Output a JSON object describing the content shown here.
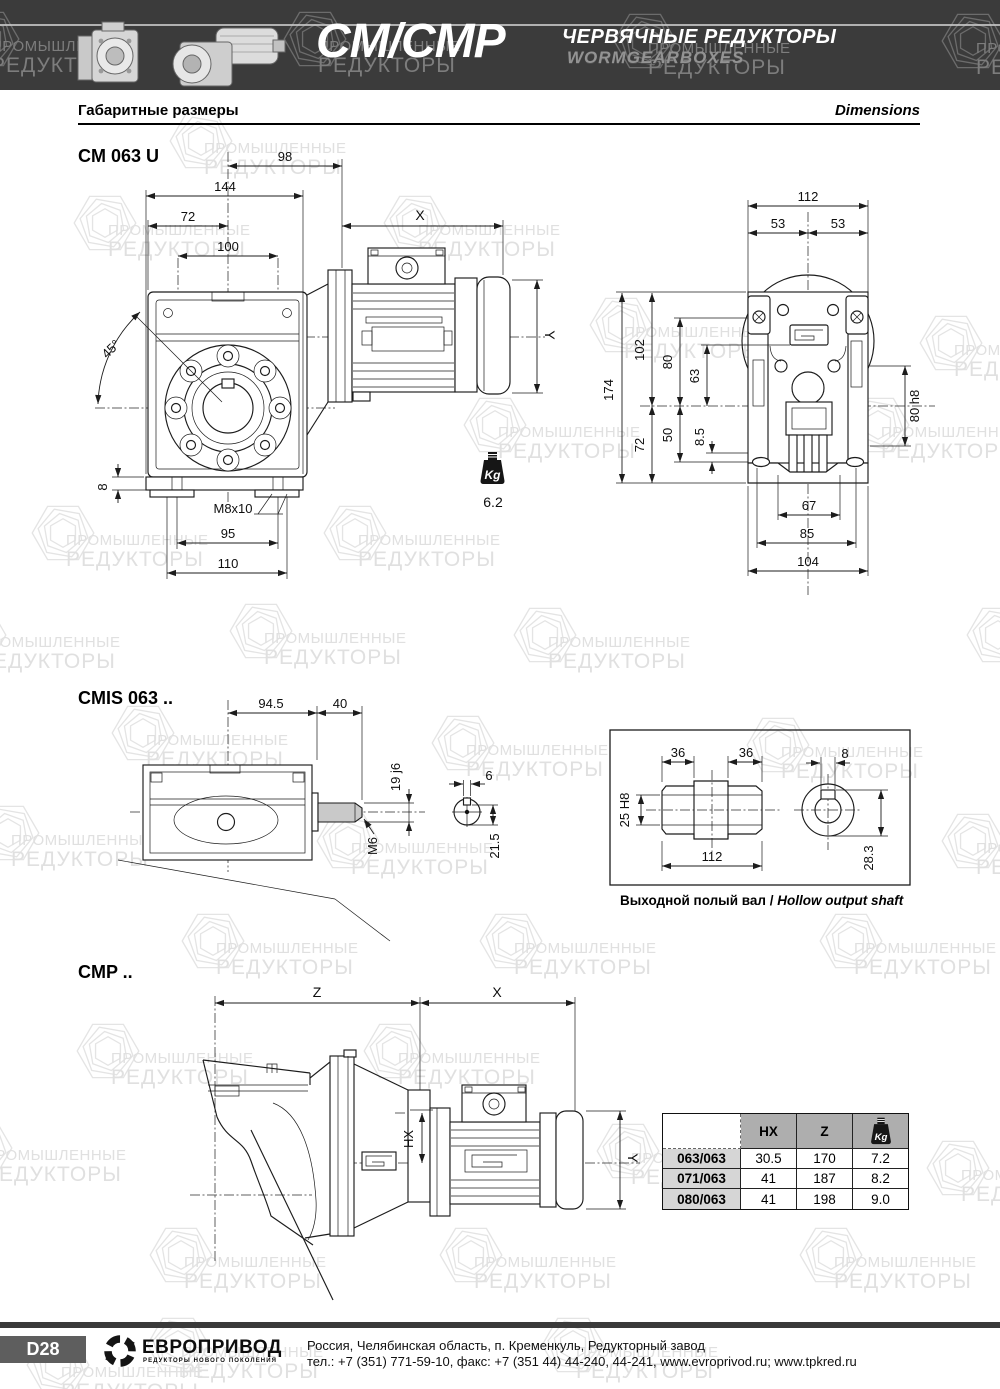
{
  "watermark": {
    "line1": "ПРОМЫШЛЕННЫЕ",
    "line2": "РЕДУКТОРЫ"
  },
  "header": {
    "model": "CM/CMP",
    "title_ru": "ЧЕРВЯЧНЫЕ РЕДУКТОРЫ",
    "title_en": "WORMGEARBOXES"
  },
  "subheader": {
    "left": "Габаритные размеры",
    "right": "Dimensions"
  },
  "weight_icon_label": "Kg",
  "cm063u": {
    "title": "CM 063 U",
    "front": {
      "d98": "98",
      "d144": "144",
      "d72": "72",
      "d100": "100",
      "dX": "X",
      "dY": "Y",
      "angle": "45°",
      "d8": "8",
      "thread": "M8x10",
      "d95": "95",
      "d110": "110",
      "weight": "6.2"
    },
    "side": {
      "d112": "112",
      "d53l": "53",
      "d53r": "53",
      "d174": "174",
      "d102": "102",
      "d80": "80",
      "d63": "63",
      "d72": "72",
      "d50": "50",
      "d8_5": "8.5",
      "d80h8": "80 h8",
      "d67": "67",
      "d85": "85",
      "d104": "104"
    }
  },
  "cmis063": {
    "title": "CMIS 063 ..",
    "d945": "94.5",
    "d40": "40",
    "d19j6": "19 j6",
    "m6": "M6",
    "d6": "6",
    "d215": "21.5"
  },
  "hollow": {
    "d36l": "36",
    "d36r": "36",
    "d8": "8",
    "d25h8": "25 H8",
    "d112": "112",
    "d283": "28.3",
    "caption_ru": "Выходной полый вал",
    "caption_sep": " / ",
    "caption_en": "Hollow output shaft"
  },
  "cmp": {
    "title": "CMP ..",
    "dZ": "Z",
    "dX": "X",
    "dHX": "HX",
    "dY": "Y",
    "table": {
      "col_hx": "HX",
      "col_z": "Z",
      "rows": [
        {
          "name": "063/063",
          "hx": "30.5",
          "z": "170",
          "kg": "7.2"
        },
        {
          "name": "071/063",
          "hx": "41",
          "z": "187",
          "kg": "8.2"
        },
        {
          "name": "080/063",
          "hx": "41",
          "z": "198",
          "kg": "9.0"
        }
      ]
    }
  },
  "footer": {
    "page": "D28",
    "brand": "ЕВРОПРИВОД",
    "tagline": "РЕДУКТОРЫ НОВОГО ПОКОЛЕНИЯ",
    "address": "Россия, Челябинская область, п. Кременкуль, Редукторный завод",
    "contacts": "тел.: +7 (351) 771-59-10, факс: +7 (351 44) 44-240, 44-241, www.evroprivod.ru; www.tpkred.ru"
  }
}
